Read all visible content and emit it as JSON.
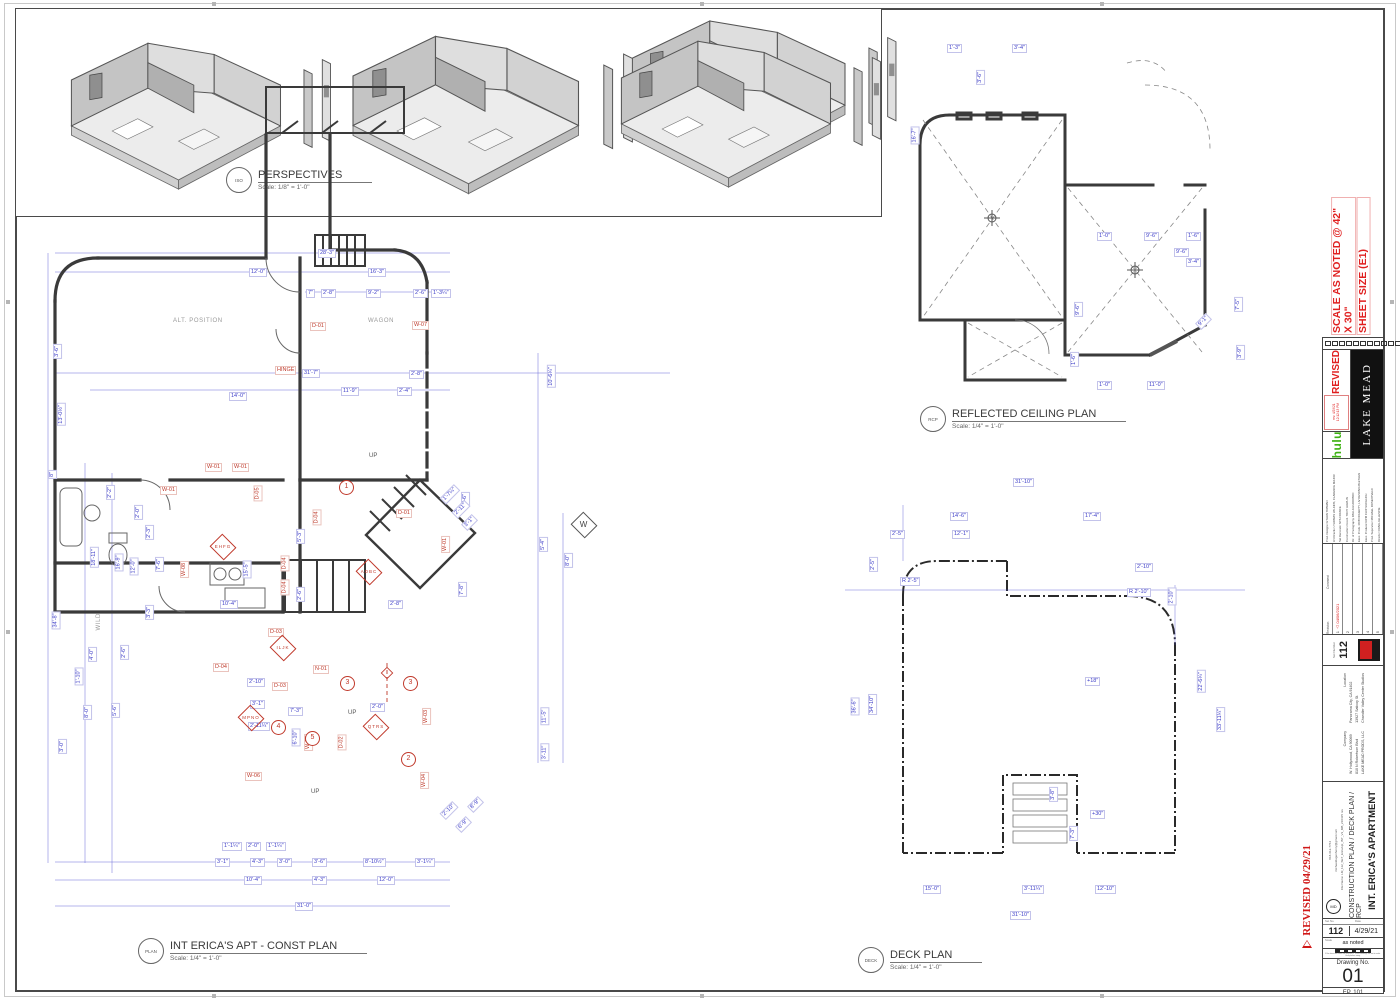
{
  "perspectives": {
    "tag": "ISO",
    "title": "PERSPECTIVES",
    "scale": "Scale: 1/8\" = 1'-0\""
  },
  "const_plan": {
    "tag": "PLAN",
    "title": "INT ERICA'S APT - CONST PLAN",
    "scale": "Scale: 1/4\" = 1'-0\"",
    "labels": [
      {
        "t": "28'-3\"",
        "x": 318,
        "y": 249
      },
      {
        "t": "12'-0\"",
        "x": 249,
        "y": 268
      },
      {
        "t": "16'-3\"",
        "x": 368,
        "y": 268
      },
      {
        "t": "7\"",
        "x": 306,
        "y": 289
      },
      {
        "t": "2'-8\"",
        "x": 321,
        "y": 289
      },
      {
        "t": "9'-2\"",
        "x": 366,
        "y": 289
      },
      {
        "t": "2'-6\"",
        "x": 413,
        "y": 289
      },
      {
        "t": "1'-3¼\"",
        "x": 431,
        "y": 289
      },
      {
        "t": "31'-7\"",
        "x": 302,
        "y": 369
      },
      {
        "t": "11'-9\"",
        "x": 341,
        "y": 387
      },
      {
        "t": "14'-0\"",
        "x": 229,
        "y": 392
      },
      {
        "t": "2'-4\"",
        "x": 397,
        "y": 387
      },
      {
        "t": "2'-8\"",
        "x": 409,
        "y": 370
      },
      {
        "t": "10'-6¼\"",
        "x": 540,
        "y": 372,
        "r": -90
      },
      {
        "t": "3'-6\"",
        "x": 50,
        "y": 347,
        "r": -90
      },
      {
        "t": "13'-0½\"",
        "x": 50,
        "y": 410,
        "r": -90
      },
      {
        "t": "8\"",
        "x": 48,
        "y": 470,
        "r": -90
      },
      {
        "t": "34'-8\"",
        "x": 47,
        "y": 616,
        "r": -90
      },
      {
        "t": "18'-11\"",
        "x": 84,
        "y": 553,
        "r": -90
      },
      {
        "t": "16'-9\"",
        "x": 110,
        "y": 558,
        "r": -90
      },
      {
        "t": "12'-0\"",
        "x": 125,
        "y": 562,
        "r": -90
      },
      {
        "t": "2'-2\"",
        "x": 103,
        "y": 488,
        "r": -90
      },
      {
        "t": "2'-0\"",
        "x": 131,
        "y": 508,
        "r": -90
      },
      {
        "t": "2'-3\"",
        "x": 142,
        "y": 528,
        "r": -90
      },
      {
        "t": "7'-6\"",
        "x": 152,
        "y": 560,
        "r": -90
      },
      {
        "t": "3'-3\"",
        "x": 142,
        "y": 608,
        "r": -90
      },
      {
        "t": "2'-6\"",
        "x": 117,
        "y": 648,
        "r": -90
      },
      {
        "t": "4'-0\"",
        "x": 85,
        "y": 650,
        "r": -90
      },
      {
        "t": "1'-10\"",
        "x": 70,
        "y": 672,
        "r": -90
      },
      {
        "t": "8'-0\"",
        "x": 80,
        "y": 708,
        "r": -90
      },
      {
        "t": "5'-6\"",
        "x": 108,
        "y": 706,
        "r": -90
      },
      {
        "t": "3'-0\"",
        "x": 55,
        "y": 742,
        "r": -90
      },
      {
        "t": "3'-1\"",
        "x": 215,
        "y": 858
      },
      {
        "t": "4'-3\"",
        "x": 250,
        "y": 858
      },
      {
        "t": "3'-0\"",
        "x": 277,
        "y": 858
      },
      {
        "t": "3'-6\"",
        "x": 312,
        "y": 858
      },
      {
        "t": "8'-10½\"",
        "x": 363,
        "y": 858
      },
      {
        "t": "3'-1¼\"",
        "x": 415,
        "y": 858
      },
      {
        "t": "10'-4\"",
        "x": 244,
        "y": 876
      },
      {
        "t": "4'-3\"",
        "x": 312,
        "y": 876
      },
      {
        "t": "12'-0\"",
        "x": 377,
        "y": 876
      },
      {
        "t": "31'-0\"",
        "x": 295,
        "y": 902
      },
      {
        "t": "15'-5\"",
        "x": 238,
        "y": 565,
        "r": -90
      },
      {
        "t": "10'-4\"",
        "x": 220,
        "y": 600
      },
      {
        "t": "2'-8\"",
        "x": 388,
        "y": 600
      },
      {
        "t": "5'-3\"",
        "x": 293,
        "y": 532,
        "r": -90
      },
      {
        "t": "2'-6\"",
        "x": 293,
        "y": 590,
        "r": -90
      },
      {
        "t": "7'-8\"",
        "x": 455,
        "y": 585,
        "r": -90
      },
      {
        "t": "4'-6\"",
        "x": 458,
        "y": 495,
        "r": -90
      },
      {
        "t": "2'-10\"",
        "x": 247,
        "y": 678
      },
      {
        "t": "3'-1\"",
        "x": 250,
        "y": 700
      },
      {
        "t": "2'-11¼\"",
        "x": 248,
        "y": 722
      },
      {
        "t": "7'-3\"",
        "x": 288,
        "y": 707
      },
      {
        "t": "6'-10\"",
        "x": 287,
        "y": 733,
        "r": -90
      },
      {
        "t": "2'-0\"",
        "x": 370,
        "y": 703
      },
      {
        "t": "5'-4\"",
        "x": 536,
        "y": 540,
        "r": -90
      },
      {
        "t": "8'-0\"",
        "x": 561,
        "y": 556,
        "r": -90
      },
      {
        "t": "11'-5\"",
        "x": 536,
        "y": 712,
        "r": -90
      },
      {
        "t": "3'-11\"",
        "x": 536,
        "y": 748,
        "r": -90
      },
      {
        "t": "1'-7¼\"",
        "x": 440,
        "y": 490,
        "r": -45
      },
      {
        "t": "2'-11\"",
        "x": 452,
        "y": 505,
        "r": -45
      },
      {
        "t": "3'-1\"",
        "x": 462,
        "y": 518,
        "r": -45
      },
      {
        "t": "2'-10\"",
        "x": 440,
        "y": 806,
        "r": -45
      },
      {
        "t": "6'-9\"",
        "x": 456,
        "y": 820,
        "r": -45
      },
      {
        "t": "8'-9\"",
        "x": 468,
        "y": 800,
        "r": -45
      },
      {
        "t": "1'-1¼\"",
        "x": 222,
        "y": 842
      },
      {
        "t": "2'-0\"",
        "x": 246,
        "y": 842
      },
      {
        "t": "1'-1¼\"",
        "x": 266,
        "y": 842
      },
      {
        "t": "W-01",
        "x": 205,
        "y": 463,
        "c": "red"
      },
      {
        "t": "W-01",
        "x": 232,
        "y": 463,
        "c": "red"
      },
      {
        "t": "W-01",
        "x": 160,
        "y": 486,
        "c": "red"
      },
      {
        "t": "W-08",
        "x": 176,
        "y": 565,
        "r": -90,
        "c": "red"
      },
      {
        "t": "W-06",
        "x": 245,
        "y": 772,
        "c": "red"
      },
      {
        "t": "W-05",
        "x": 300,
        "y": 738,
        "r": -90,
        "c": "red"
      },
      {
        "t": "W-03",
        "x": 418,
        "y": 712,
        "r": -90,
        "c": "red"
      },
      {
        "t": "W-04",
        "x": 416,
        "y": 776,
        "r": -90,
        "c": "red"
      },
      {
        "t": "W-07",
        "x": 412,
        "y": 321,
        "c": "red"
      },
      {
        "t": "W-01",
        "x": 437,
        "y": 540,
        "r": -90,
        "c": "red"
      },
      {
        "t": "D-01",
        "x": 310,
        "y": 322,
        "c": "red"
      },
      {
        "t": "D-01",
        "x": 396,
        "y": 509,
        "c": "red"
      },
      {
        "t": "D-05",
        "x": 250,
        "y": 489,
        "r": -90,
        "c": "red"
      },
      {
        "t": "D-04",
        "x": 309,
        "y": 513,
        "r": -90,
        "c": "red"
      },
      {
        "t": "D-04",
        "x": 277,
        "y": 559,
        "r": -90,
        "c": "red"
      },
      {
        "t": "D-04",
        "x": 277,
        "y": 583,
        "r": -90,
        "c": "red"
      },
      {
        "t": "D-04",
        "x": 213,
        "y": 663,
        "c": "red"
      },
      {
        "t": "D-03",
        "x": 272,
        "y": 682,
        "c": "red"
      },
      {
        "t": "D-03",
        "x": 268,
        "y": 628,
        "c": "red"
      },
      {
        "t": "D-02",
        "x": 334,
        "y": 738,
        "r": -90,
        "c": "red"
      },
      {
        "t": "N-01",
        "x": 313,
        "y": 665,
        "c": "red"
      },
      {
        "t": "HINGE",
        "x": 275,
        "y": 366,
        "c": "red"
      },
      {
        "t": "WAGON",
        "x": 367,
        "y": 318,
        "c": "gray"
      },
      {
        "t": "ALT. POSITION",
        "x": 172,
        "y": 318,
        "c": "gray"
      },
      {
        "t": "WILD",
        "x": 90,
        "y": 618,
        "r": -90,
        "c": "gray"
      },
      {
        "t": "UP",
        "x": 368,
        "y": 453,
        "c": "up"
      },
      {
        "t": "UP",
        "x": 310,
        "y": 789,
        "c": "up"
      },
      {
        "t": "UP",
        "x": 347,
        "y": 710,
        "c": "up"
      },
      {
        "t": "EHFG",
        "x": 222,
        "y": 547,
        "c": "dmd"
      },
      {
        "t": "ADBC",
        "x": 368,
        "y": 572,
        "c": "dmd"
      },
      {
        "t": "ILJK",
        "x": 282,
        "y": 648,
        "c": "dmd"
      },
      {
        "t": "MPNO",
        "x": 250,
        "y": 718,
        "c": "dmd"
      },
      {
        "t": "QTRS",
        "x": 375,
        "y": 727,
        "c": "dmd"
      },
      {
        "t": "W",
        "x": 583,
        "y": 525,
        "c": "dmdw"
      },
      {
        "t": "1",
        "x": 346,
        "y": 487,
        "c": "circ"
      },
      {
        "t": "3",
        "x": 347,
        "y": 683,
        "c": "circ"
      },
      {
        "t": "3",
        "x": 410,
        "y": 683,
        "c": "circ"
      },
      {
        "t": "4",
        "x": 278,
        "y": 727,
        "c": "circ"
      },
      {
        "t": "5",
        "x": 312,
        "y": 738,
        "c": "circ"
      },
      {
        "t": "2",
        "x": 408,
        "y": 759,
        "c": "circ"
      }
    ]
  },
  "rcp": {
    "tag": "RCP",
    "title": "REFLECTED CEILING PLAN",
    "scale": "Scale: 1/4\" = 1'-0\"",
    "labels": [
      {
        "t": "1'-3\"",
        "x": 947,
        "y": 44
      },
      {
        "t": "3'-4\"",
        "x": 1012,
        "y": 44
      },
      {
        "t": "3'-6\"",
        "x": 973,
        "y": 73,
        "r": -90
      },
      {
        "t": "16'-7\"",
        "x": 906,
        "y": 131,
        "r": -90
      },
      {
        "t": "1'-0\"",
        "x": 1097,
        "y": 232
      },
      {
        "t": "9'-6\"",
        "x": 1144,
        "y": 232
      },
      {
        "t": "1'-6\"",
        "x": 1186,
        "y": 232
      },
      {
        "t": "9'-6\"",
        "x": 1071,
        "y": 305,
        "r": -90
      },
      {
        "t": "7'-5\"",
        "x": 1231,
        "y": 300,
        "r": -90
      },
      {
        "t": "3'-9\"",
        "x": 1233,
        "y": 348,
        "r": -90
      },
      {
        "t": "1'-6\"",
        "x": 1067,
        "y": 355,
        "r": -90
      },
      {
        "t": "1'-0\"",
        "x": 1097,
        "y": 381
      },
      {
        "t": "11'-0\"",
        "x": 1147,
        "y": 381
      },
      {
        "t": "9'-1\"",
        "x": 1196,
        "y": 317,
        "r": -45
      },
      {
        "t": "9'-6\"",
        "x": 1174,
        "y": 248
      },
      {
        "t": "3'-4\"",
        "x": 1186,
        "y": 258
      }
    ]
  },
  "deck": {
    "tag": "DECK",
    "title": "DECK PLAN",
    "scale": "Scale: 1/4\" = 1'-0\"",
    "labels": [
      {
        "t": "31'-10\"",
        "x": 1013,
        "y": 478
      },
      {
        "t": "14'-6\"",
        "x": 950,
        "y": 512
      },
      {
        "t": "17'-4\"",
        "x": 1083,
        "y": 512
      },
      {
        "t": "2'-5\"",
        "x": 890,
        "y": 530
      },
      {
        "t": "12'-1\"",
        "x": 952,
        "y": 530
      },
      {
        "t": "2'-10\"",
        "x": 1135,
        "y": 563
      },
      {
        "t": "R 2'-5\"",
        "x": 900,
        "y": 577
      },
      {
        "t": "R 2'-10\"",
        "x": 1127,
        "y": 588
      },
      {
        "t": "2'-5\"",
        "x": 866,
        "y": 560,
        "r": -90
      },
      {
        "t": "2'-10\"",
        "x": 1163,
        "y": 592,
        "r": -90
      },
      {
        "t": "36'-6\"",
        "x": 846,
        "y": 702,
        "r": -90
      },
      {
        "t": "34'-10\"",
        "x": 862,
        "y": 700,
        "r": -90
      },
      {
        "t": "22'-6¼\"",
        "x": 1190,
        "y": 677,
        "r": -90
      },
      {
        "t": "33'-11¼\"",
        "x": 1208,
        "y": 715,
        "r": -90
      },
      {
        "t": "15'-0\"",
        "x": 923,
        "y": 885
      },
      {
        "t": "3'-11¼\"",
        "x": 1022,
        "y": 885
      },
      {
        "t": "12'-10\"",
        "x": 1095,
        "y": 885
      },
      {
        "t": "31'-10\"",
        "x": 1010,
        "y": 911
      },
      {
        "t": "+18\"",
        "x": 1085,
        "y": 677
      },
      {
        "t": "+30\"",
        "x": 1090,
        "y": 810
      },
      {
        "t": "7'-3\"",
        "x": 1066,
        "y": 829,
        "r": -90
      },
      {
        "t": "3'-8\"",
        "x": 1046,
        "y": 790,
        "r": -90
      }
    ]
  },
  "titleblock": {
    "sheet_size_line1": "SHEET SIZE (E1)",
    "sheet_size_line2": "SCALE AS NOTED @ 42\" X 30\"",
    "checkboxes": [
      "ART",
      "CONST",
      "PAINT",
      "GREENS",
      "RIG ELEC",
      "SET DEC",
      "S/FX",
      "CAM",
      "GRIP",
      "ELEC",
      "TRANSPO",
      "STUNTS",
      "PROPS",
      "VFX"
    ],
    "revised_label": "REVISED",
    "stamp_line1": "rev. 4/29/21",
    "stamp_line2": "12:12:13 PM",
    "show_logo": "hulu",
    "production_logo": "LAKE MEAD",
    "credits": [
      "Prod. Designer   ETHAN TOBMAN",
      "Art Direction   THOMAS WILKINS, CLARENCE MAJOR",
      "Set Decorator   NYA FRANCE",
      "Construction Coord.   TROY HAWLIN",
      "Dir. of Photography   PAULA HUIDOBRO",
      "Exec. Prods.   ROB DOHERTY, LIV DESPAIN-BLETHEN",
      "Exec. Producer/UPM   CHIP VUCELICH",
      "Prod. Supervisor   MICHAEL ROSENTVELD",
      "Director   CRAIG GILLESPIE"
    ],
    "rev_header_revision": "Revision",
    "rev_header_comment": "Comment",
    "revisions": [
      {
        "n": "1",
        "c": "04/06/2021"
      },
      {
        "n": "2",
        "c": ""
      },
      {
        "n": "3",
        "c": ""
      },
      {
        "n": "4",
        "c": ""
      },
      {
        "n": "5",
        "c": ""
      }
    ],
    "set_number_label": "Set Number",
    "set_number": "112",
    "studio_address": [
      "Chandler Valley Center Studios",
      "13927 Saticoy St.",
      "Panorama City, CA 91402"
    ],
    "studio_label": "Location",
    "company_address": [
      "LAKE MEAD PRODS, LLC",
      "810 N Robertson Blvd",
      "W. Hollywood, CA 90069"
    ],
    "company_label": "Company",
    "set_name": "INT. ERICA'S APARTMENT",
    "drawing_title": "CONSTRUCTION PLAN / DECK PLAN / RCP",
    "file_line": "File Name: LM_112_SET_EricaApt_INT_V3_MB_210415 rev",
    "email": "michaelduganhenry@gmail.com",
    "phone": "818-612-7764",
    "designer_logo": "MD",
    "set_no_label": "Set No.",
    "date_label": "Date",
    "set_no": "112",
    "date": "4/29/21",
    "scale_label": "Scale",
    "scale_value": "as noted",
    "caution_text": "If the above bar does not measure 1\" these drawings are not to scale. Verify before using.",
    "drawing_no_label": "Drawing No.",
    "drawing_no": "01",
    "episode": "EP. 101",
    "side_revised": "REVISED  04/29/21",
    "side_revision_number": "1"
  }
}
